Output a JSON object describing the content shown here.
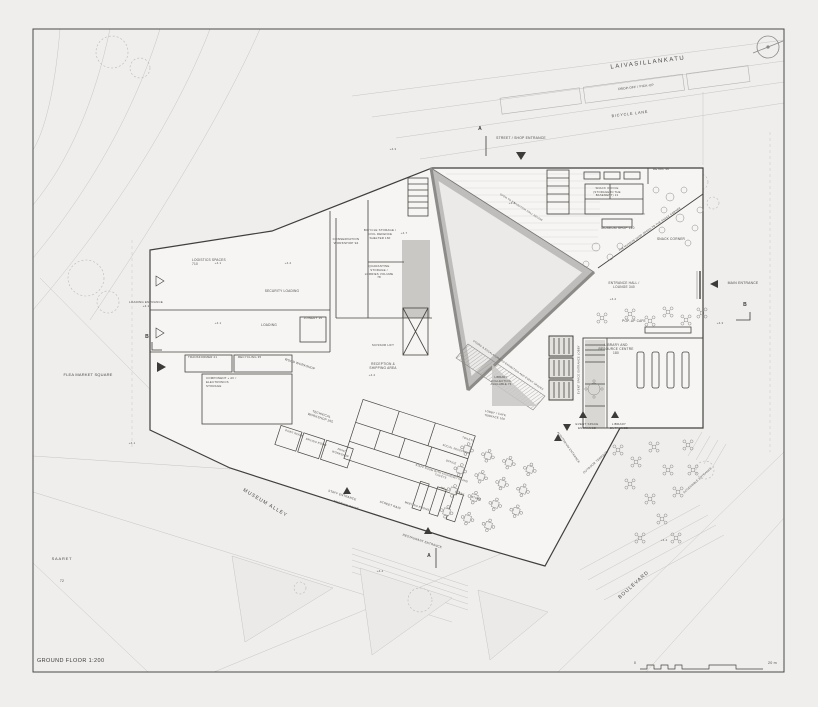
{
  "sheet": {
    "title": "GROUND FLOOR 1:200",
    "scale_zero": "0",
    "scale_max": "20 m"
  },
  "palette": {
    "paper": "#efeeec",
    "wall": "#413f3d",
    "hall_fill": "#bebdbb"
  },
  "streets": {
    "laivasillankatu": "LAIVASILLANKATU",
    "dropoff": "DROP-OFF / PICK-UP",
    "bicycle_lane": "BICYCLE LANE",
    "museum_alley": "MUSEUM ALLEY",
    "boulevard": "BOULEVARD",
    "flea_market": "FLEA MARKET SQUARE",
    "saaret": "SAARET",
    "saaret_area": "72"
  },
  "entrances": {
    "street_shop": "STREET / SHOP ENTRANCE",
    "main": "MAIN ENTRANCE",
    "loading": "LOADING ENTRANCE +4.1",
    "staff": "STAFF ENTRANCE",
    "meeting_point": "MEETING POINT",
    "restaurant": "RESTAURANT ENTRANCE",
    "event_space": "EVENT SPACE ENTRANCE",
    "library": "LIBRARY ENTRANCE",
    "auditorium": "AUDITORIUM ENTRANCE",
    "accessible": "ACCESSIBLE ENTRANCE"
  },
  "rooms": {
    "retail": "RETAIL 46",
    "snack_office": "SNACK OFFICE (STORAGE IN THE BASEMENT) 13",
    "museum_shop": "MUSEUM SHOP 140",
    "snack_corner": "SNACK CORNER",
    "entrance_hall": "ENTRANCE HALL / LOUNGE 340",
    "popup_cafe": "POP-UP CAFE",
    "library_centre": "LIBRARY AND RESOURCE CENTRE 180",
    "library_collection": "LIBRARY COLLECTION AVAILABLE 74",
    "lobby_cafe": "LOBBY / CAFE TERRACE 100",
    "event_lobby": "EVENT SPACE ENTRANCE LOBBY",
    "reception": "RECEPTION & SHIPPING AREA",
    "scissor_lift": "SCISSOR LIFT",
    "conservation": "CONSERVATION WORKSHOP 94",
    "bicycle_storage": "BICYCLE STORAGE / CIVIL DEFENCE SHELTER 160",
    "quarantine": "QUARANTINE STORAGE / LORRIES VOLUME 78",
    "logistics": "LOGISTICS SPACES 710",
    "security_loading": "SECURITY LOADING",
    "loading": "LOADING",
    "joinery": "JOINERY 15",
    "transformer": "TRANSFORMER 21",
    "recycling": "RECYCLING 35",
    "component_av": "COMPONENT + AV / ELECTRONICS STORAGE",
    "wood_workshop": "WOOD WORKSHOP",
    "technical_workshop": "TECHNICAL WORKSHOP 255",
    "paint_room": "PAINT ROOM",
    "drying_room": "DRYING ROOM",
    "paint_workshop": "PAINT WORKSHOP",
    "social_reception": "SOCIAL RECEPTION",
    "staff_room": "STAFF ROOM WITH KITCHENETTE AND TOILETS",
    "office": "OFFICE",
    "toilets": "TOILETS",
    "wc": "WC",
    "clean": "CLEAN.",
    "store": "STORE",
    "meeting_rooms": "MEETING ROOMS"
  },
  "annotations": {
    "shop_extends": "THE MUSEUM SHOP OPENS TO THE SNACK CORNER",
    "open_to_hall": "OPEN TO EXHIBITION HALL BELOW",
    "escalators": "STAIRS & ESCALATORS TO EXHIBITION AND EVENT SPACES",
    "street_rain": "STREET RAIN",
    "outdoor_terrace": "OUTDOOR TERRACE"
  },
  "levels": [
    "+4.3",
    "+4.2",
    "+4.7",
    "+4.2",
    "+4.3",
    "+4.2",
    "+4.1",
    "+4.1",
    "+4.2",
    "+4.4",
    "+4.4",
    "+4.1"
  ],
  "section_markers": {
    "a": "A",
    "b": "B"
  }
}
